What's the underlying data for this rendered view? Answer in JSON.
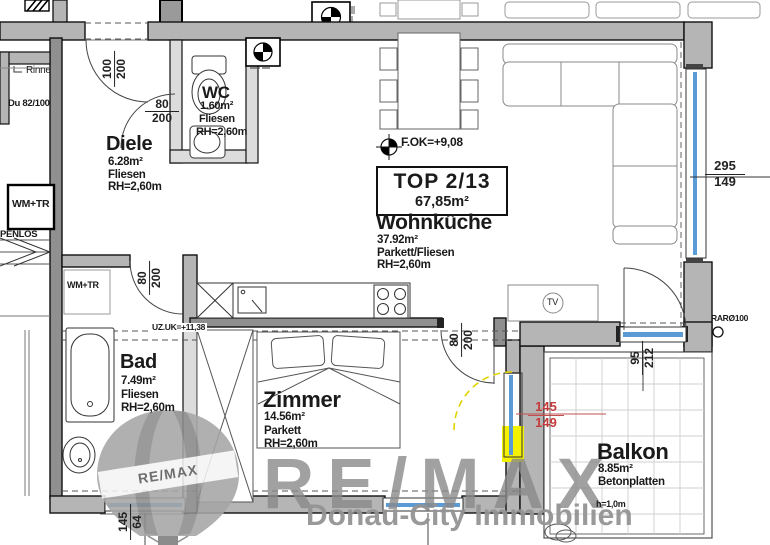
{
  "title_box": {
    "unit": "TOP 2/13",
    "total_area": "67,85m²"
  },
  "rooms": [
    {
      "name": "Diele",
      "area": "6.28m²",
      "floor": "Fliesen",
      "height": "RH=2,60m"
    },
    {
      "name": "WC",
      "area": "1.60m²",
      "floor": "Fliesen",
      "height": "RH=2,60m"
    },
    {
      "name": "Wohnküche",
      "area": "37.92m²",
      "floor": "Parkett/Fliesen",
      "height": "RH=2,60m"
    },
    {
      "name": "Bad",
      "area": "7.49m²",
      "floor": "Fliesen",
      "height": "RH=2,60m"
    },
    {
      "name": "Zimmer",
      "area": "14.56m²",
      "floor": "Parkett",
      "height": "RH=2,60m"
    },
    {
      "name": "Balkon",
      "area": "8.85m²",
      "floor": "Betonplatten",
      "height_note": "h=1,0m"
    }
  ],
  "dims": {
    "entrance_door": {
      "top": "100",
      "bottom": "200"
    },
    "wc_door": {
      "top": "80",
      "bottom": "200"
    },
    "bad_door": {
      "top": "80",
      "bottom": "200"
    },
    "zimmer_door": {
      "top": "80",
      "bottom": "200"
    },
    "right_window": {
      "top": "295",
      "bottom": "149"
    },
    "balcony_door": {
      "top": "95",
      "bottom": "212"
    },
    "zimmer_window": {
      "top": "145",
      "bottom": "149"
    },
    "bad_window": {
      "top": "145",
      "bottom": "64"
    }
  },
  "annotations": {
    "rinne": "Rinne",
    "du": "Du 82/100",
    "wm_tr": "WM+TR",
    "penlos": "PENLOS",
    "uz": "UZ.UK=+11,38",
    "fok": "F.OK=+9,08",
    "rar": "RARØ100",
    "tv": "TV"
  },
  "watermark": {
    "brand": "RE/MAX",
    "balloon_text": "RE/MAX",
    "company": "Donau-City Immobilien"
  },
  "colors": {
    "wall_gray": "#b5b5b5",
    "wall_dark": "#909090",
    "glazing_blue": "#5b9bd5",
    "highlight_yellow": "#f5f200",
    "changed_red": "#c43b3b",
    "watermark_gray": "#8a8a8a"
  }
}
